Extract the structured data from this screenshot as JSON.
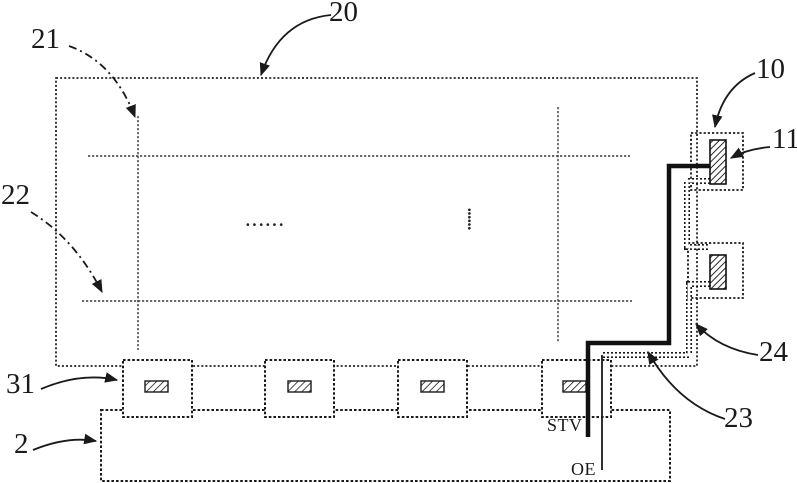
{
  "figure": {
    "labels": {
      "panel": "20",
      "data_line": "21",
      "gate_line": "22",
      "pad_region": "10",
      "pad": "11",
      "trace_right": "24",
      "trace_left": "23",
      "driver_chip": "31",
      "board": "2",
      "signal_stv": "STV",
      "signal_oe": "OE",
      "ellipsis_horizontal": "······",
      "ellipsis_vertical": "······"
    },
    "colors": {
      "ink": "#1a1a1a",
      "background": "#ffffff"
    }
  }
}
